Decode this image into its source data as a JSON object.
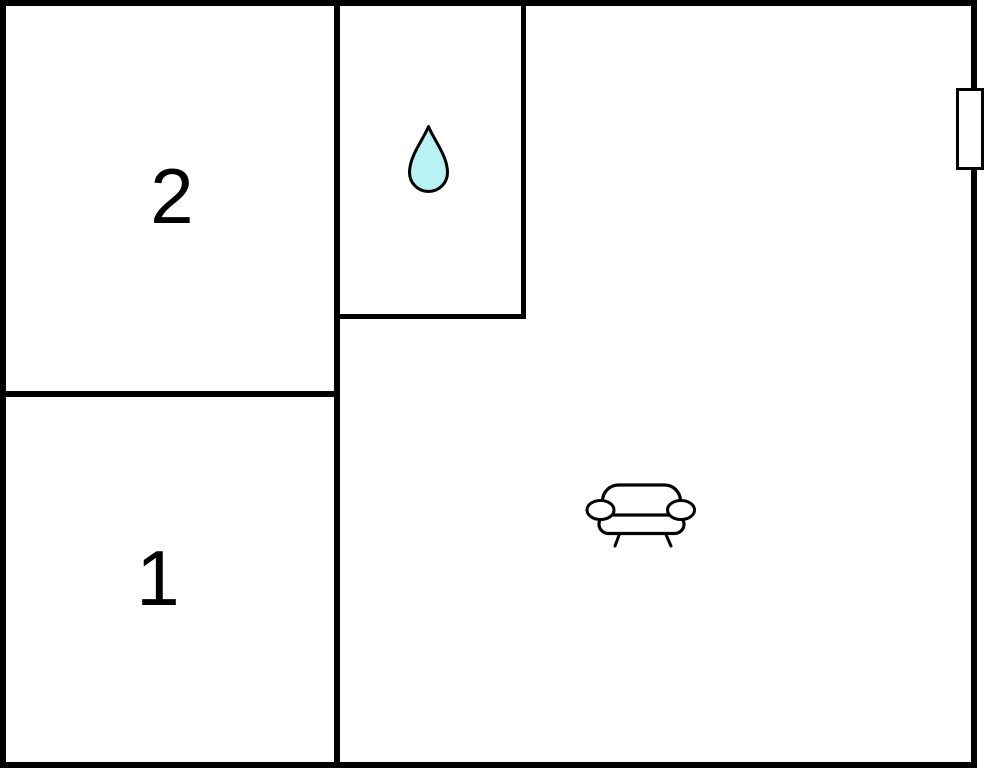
{
  "plan": {
    "background_color": "#ffffff",
    "wall_color": "#000000",
    "rooms": {
      "room2": {
        "label": "2"
      },
      "room1": {
        "label": "1"
      },
      "bathroom": {
        "icon": "water-drop-icon"
      },
      "living_room": {
        "icon": "sofa-icon"
      }
    },
    "fixtures": {
      "window": {
        "location": "right-exterior-wall"
      },
      "water_drop_fill": "#b8f2f2",
      "icon_stroke": "#000000"
    }
  }
}
